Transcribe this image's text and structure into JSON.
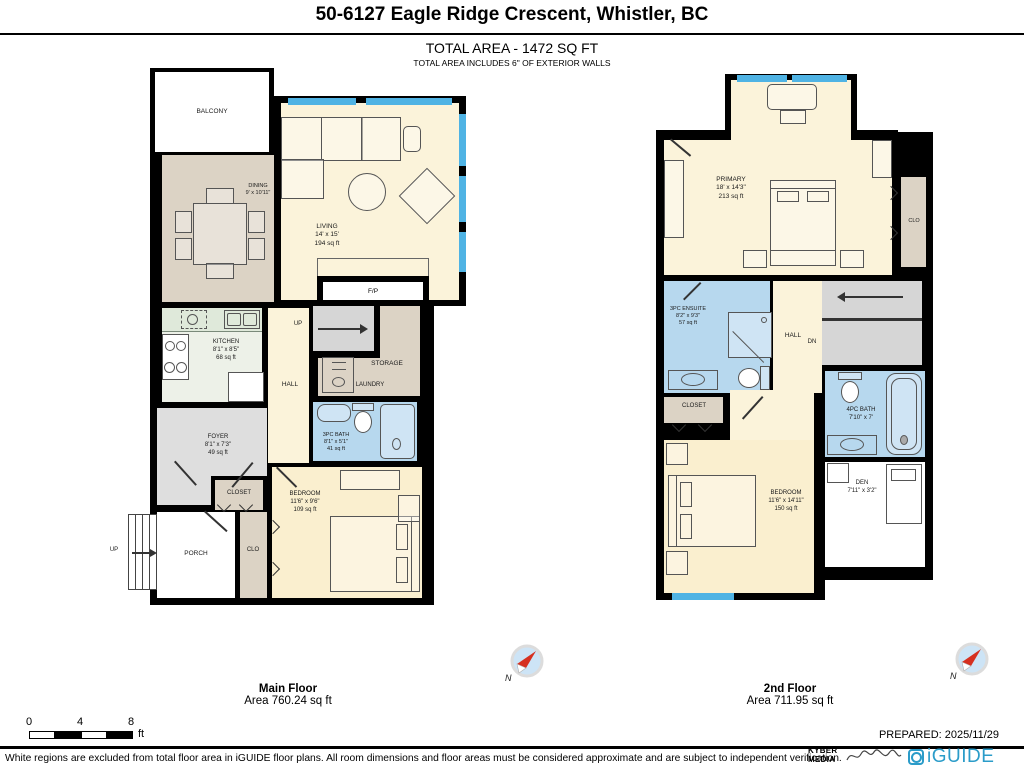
{
  "header": {
    "title": "50-6127 Eagle Ridge Crescent, Whistler, BC",
    "total_area": "TOTAL AREA - 1472 SQ FT",
    "total_area_note": "TOTAL AREA INCLUDES 6\" OF EXTERIOR WALLS"
  },
  "main_floor": {
    "caption": "Main Floor",
    "area_caption": "Area 760.24 sq ft",
    "compass_label": "N",
    "rooms": {
      "balcony": {
        "name": "BALCONY"
      },
      "dining": {
        "name": "DINING",
        "dims": "9' x 10'11\""
      },
      "living": {
        "name": "LIVING",
        "dims": "14' x 15'",
        "area": "194 sq ft"
      },
      "fireplace": {
        "name": "F/P"
      },
      "kitchen": {
        "name": "KITCHEN",
        "dims": "8'1\" x 8'5\"",
        "area": "68 sq ft"
      },
      "stairs_up": {
        "name": "UP"
      },
      "hall": {
        "name": "HALL"
      },
      "storage": {
        "name": "STORAGE"
      },
      "laundry": {
        "name": "LAUNDRY"
      },
      "bath": {
        "name": "3PC BATH",
        "dims": "8'1\" x 5'1\"",
        "area": "41 sq ft"
      },
      "foyer": {
        "name": "FOYER",
        "dims": "8'1\" x 7'3\"",
        "area": "49 sq ft"
      },
      "closet": {
        "name": "CLOSET"
      },
      "clo": {
        "name": "CLO"
      },
      "porch": {
        "name": "PORCH"
      },
      "entry_stairs": {
        "name": "UP"
      },
      "bedroom": {
        "name": "BEDROOM",
        "dims": "11'6\" x 9'6\"",
        "area": "109 sq ft"
      }
    }
  },
  "second_floor": {
    "caption": "2nd Floor",
    "area_caption": "Area 711.95 sq ft",
    "compass_label": "N",
    "rooms": {
      "primary": {
        "name": "PRIMARY",
        "dims": "18' x 14'3\"",
        "area": "213 sq ft"
      },
      "clo": {
        "name": "CLO"
      },
      "ensuite": {
        "name": "3PC ENSUITE",
        "dims": "8'2\" x 9'3\"",
        "area": "57 sq ft"
      },
      "hall": {
        "name": "HALL"
      },
      "dn": {
        "name": "DN"
      },
      "closet": {
        "name": "CLOSET"
      },
      "bath": {
        "name": "4PC BATH",
        "dims": "7'10\" x 7'"
      },
      "bedroom": {
        "name": "BEDROOM",
        "dims": "11'6\" x 14'11\"",
        "area": "150 sq ft"
      },
      "den": {
        "name": "DEN",
        "dims": "7'11\" x 3'2\""
      }
    }
  },
  "scale_bar": {
    "zero": "0",
    "four": "4",
    "eight": "8",
    "unit": "ft"
  },
  "prepared": "PREPARED: 2025/11/29",
  "footer": {
    "disclaimer": "White regions are excluded from total floor area in iGUIDE floor plans. All room dimensions and floor areas must be considered approximate and are subject to independent verification.",
    "kyber_top": "KYBER",
    "kyber_bottom": "MEDIA",
    "brand": "iGUIDE"
  },
  "colors": {
    "wall": "#000000",
    "window": "#4fb3e4",
    "cream": "#fbf3da",
    "cream2": "#faefcf",
    "tan": "#dcd3c5",
    "gray": "#dedede",
    "stair": "#d6d6d6",
    "mint": "#edf1e8",
    "blue": "#b7d8ee",
    "tub": "#cfe4f4",
    "brand": "#2b9cc9",
    "compass_red": "#d63020"
  }
}
